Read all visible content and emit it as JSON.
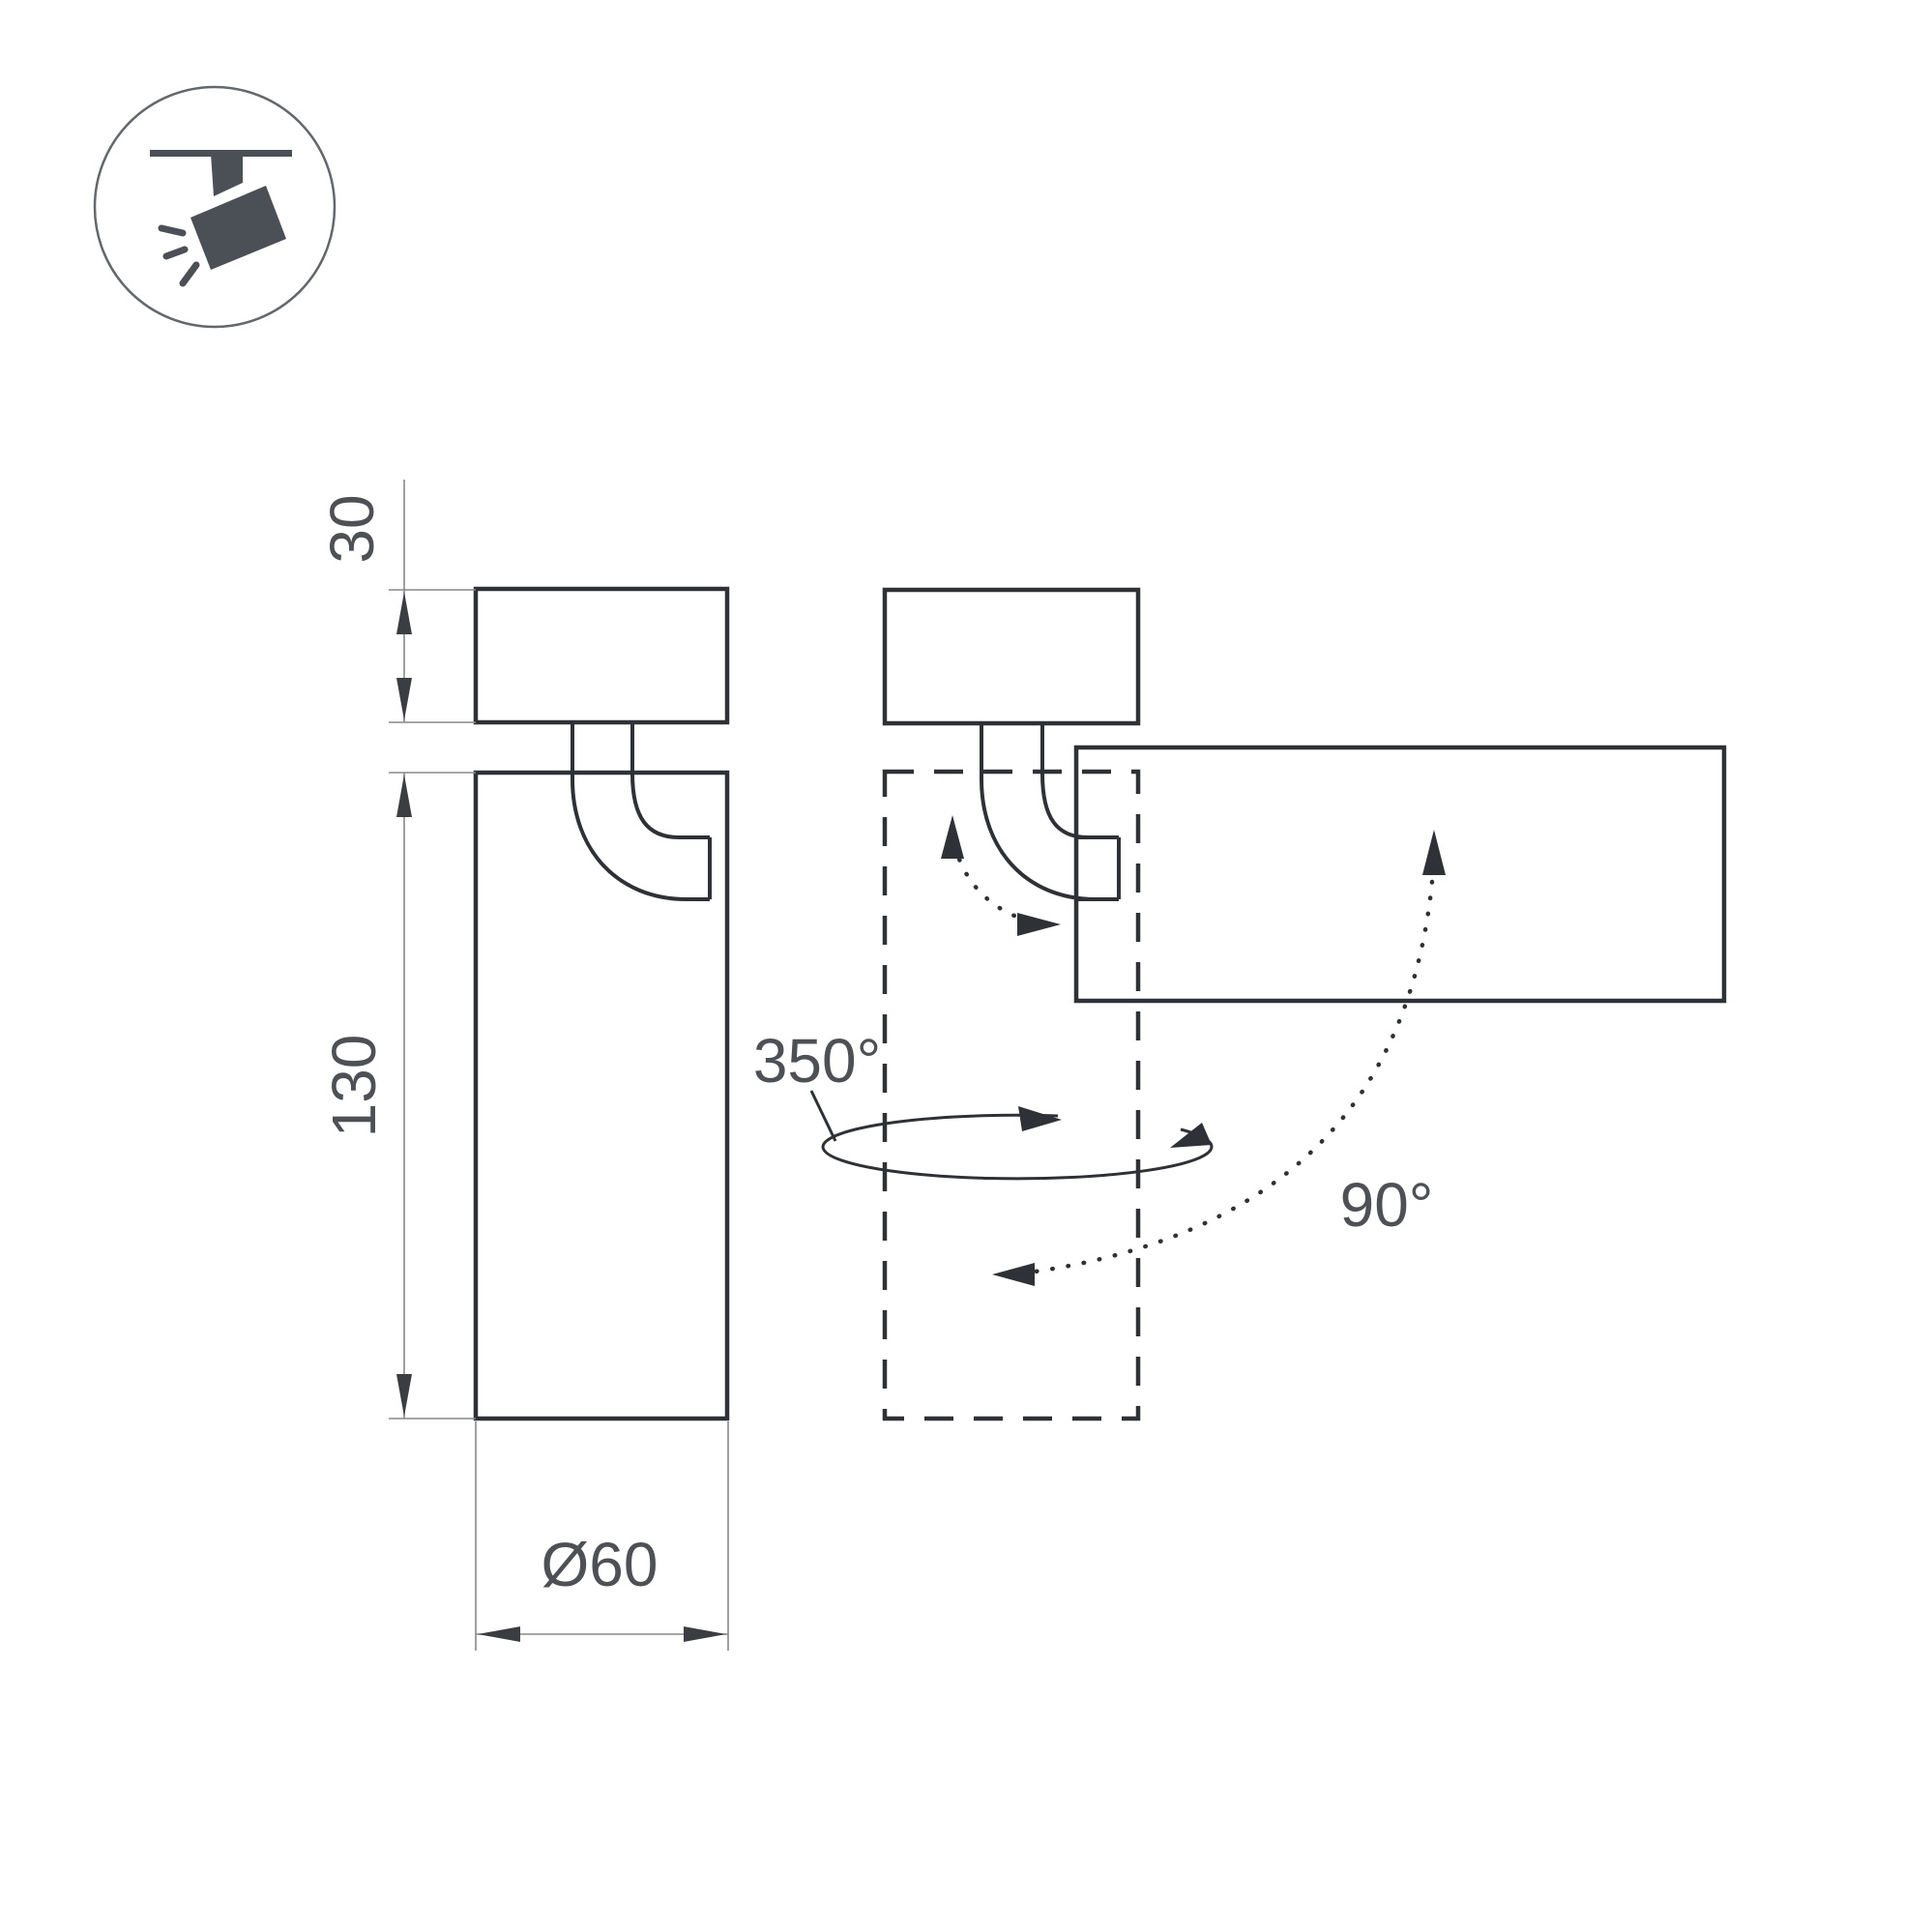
{
  "icon": {
    "name": "ceiling-track-spotlight"
  },
  "dimensions": {
    "mount_height": "30",
    "body_height": "130",
    "diameter": "Ø60"
  },
  "rotation": {
    "swivel": "350°",
    "tilt": "90°"
  },
  "colors": {
    "line": "#2e3236",
    "thin": "#85898c",
    "text": "#4d5156",
    "icon": "#4a5056",
    "bg": "#ffffff"
  }
}
